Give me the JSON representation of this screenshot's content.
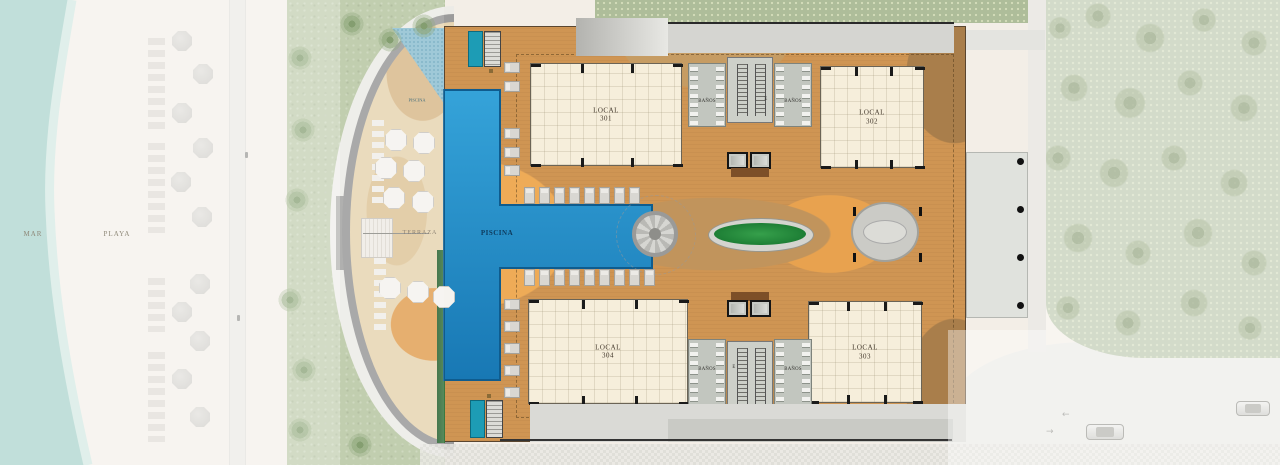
{
  "plan": {
    "areas": {
      "sea": "MAR",
      "beach": "PLAYA",
      "terrace": "TERRAZA",
      "pool": "PISCINA",
      "pool_small": "PISCINA"
    },
    "units": [
      {
        "name": "LOCAL",
        "number": "301"
      },
      {
        "name": "LOCAL",
        "number": "302"
      },
      {
        "name": "LOCAL",
        "number": "304"
      },
      {
        "name": "LOCAL",
        "number": "303"
      }
    ],
    "rooms": {
      "bathroom": "BAÑOS",
      "elevator": "E"
    }
  },
  "colors": {
    "sea": "#9ccbc3",
    "grass": "#b7c6a2",
    "forest": "#b6c3a7",
    "deck": "#cf9553",
    "pool": "#1b7fc0",
    "unit_fill": "#f6eedb"
  }
}
